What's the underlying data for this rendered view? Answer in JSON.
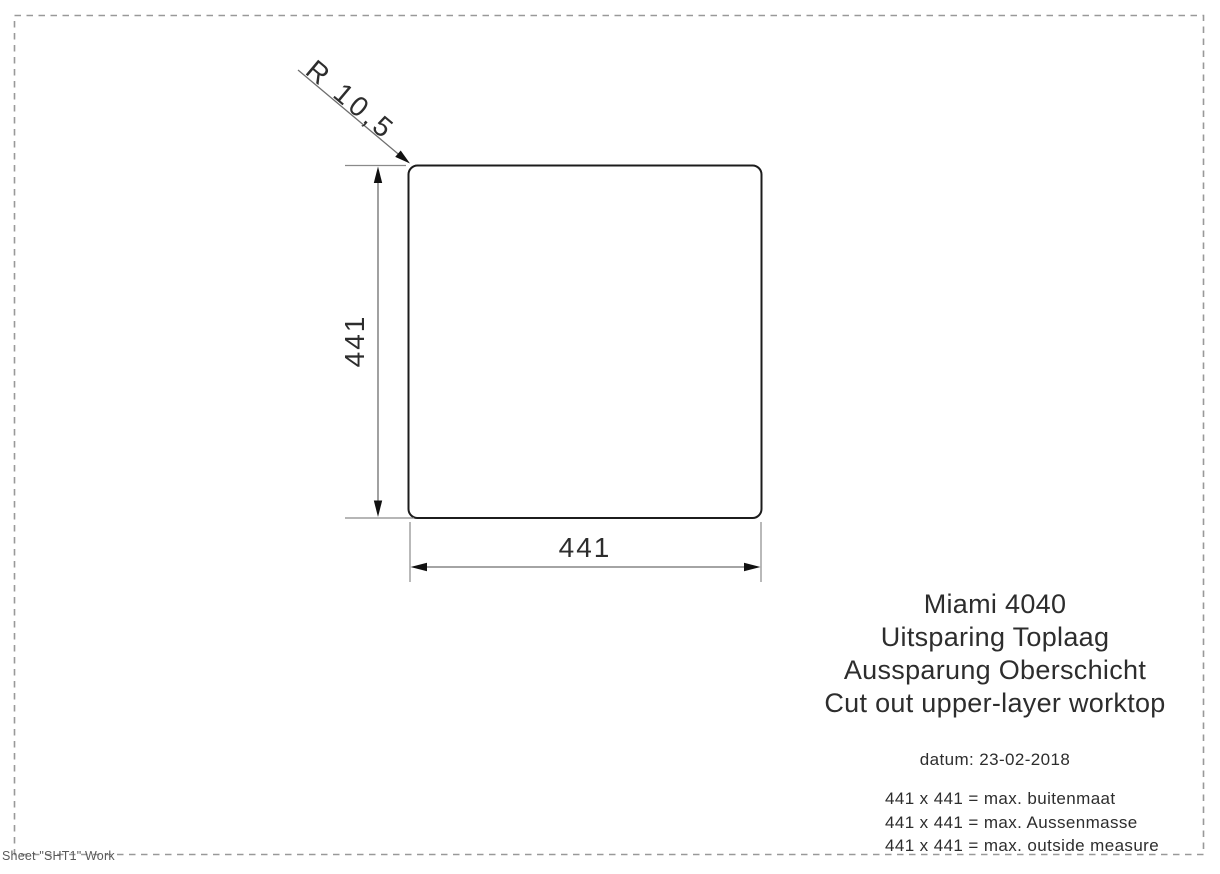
{
  "drawing": {
    "radius_label": "R 10,5",
    "dim_height": "441",
    "dim_width": "441"
  },
  "title_block": {
    "lines": [
      "Miami 4040",
      "Uitsparing Toplaag",
      "Aussparung Oberschicht",
      "Cut out upper-layer worktop"
    ],
    "date": "datum: 23-02-2018",
    "measures": [
      "441 x 441 = max. buitenmaat",
      "441 x 441 = max. Aussenmasse",
      "441 x 441 = max. outside measure"
    ]
  },
  "footer": {
    "sheet_label": "Sheet \"SHT1\" Work"
  },
  "colors": {
    "outline": "#1c1c1c",
    "dimension": "#6e6e6e",
    "extension": "#8a8a8a",
    "border": "#999999",
    "arrow": "#111111",
    "text": "#2d2d2d"
  }
}
